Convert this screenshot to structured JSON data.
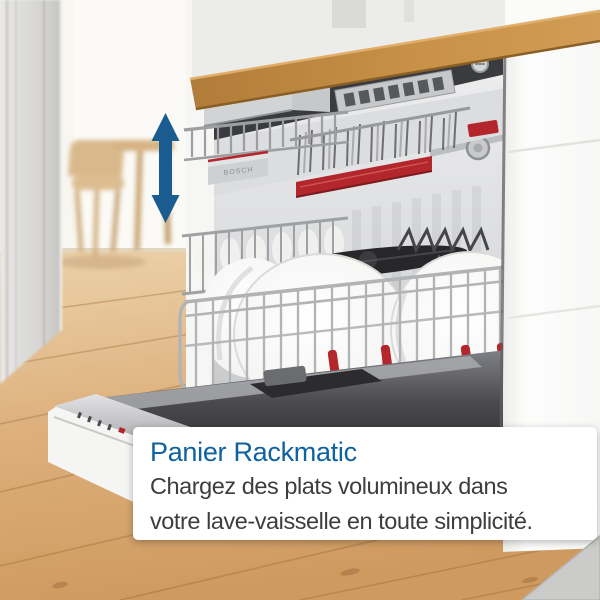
{
  "caption_card": {
    "title": "Panier Rackmatic",
    "body_line1": "Chargez des plats volumineux dans",
    "body_line2": "votre lave-vaisselle en toute simplicité."
  },
  "branding": {
    "logo_text": "BOSCH"
  },
  "icons": {
    "vertical_double_arrow": "rack-height-adjustment-arrow"
  },
  "colors": {
    "accent_blue": "#0f62a0",
    "arrow_blue": "#1a5c90",
    "bosch_red": "#b3262c",
    "card_bg": "#ffffff",
    "body_text": "#3d3d3d",
    "counter_wood": "#bf8a45",
    "floor_wood": "#d8a86f"
  }
}
